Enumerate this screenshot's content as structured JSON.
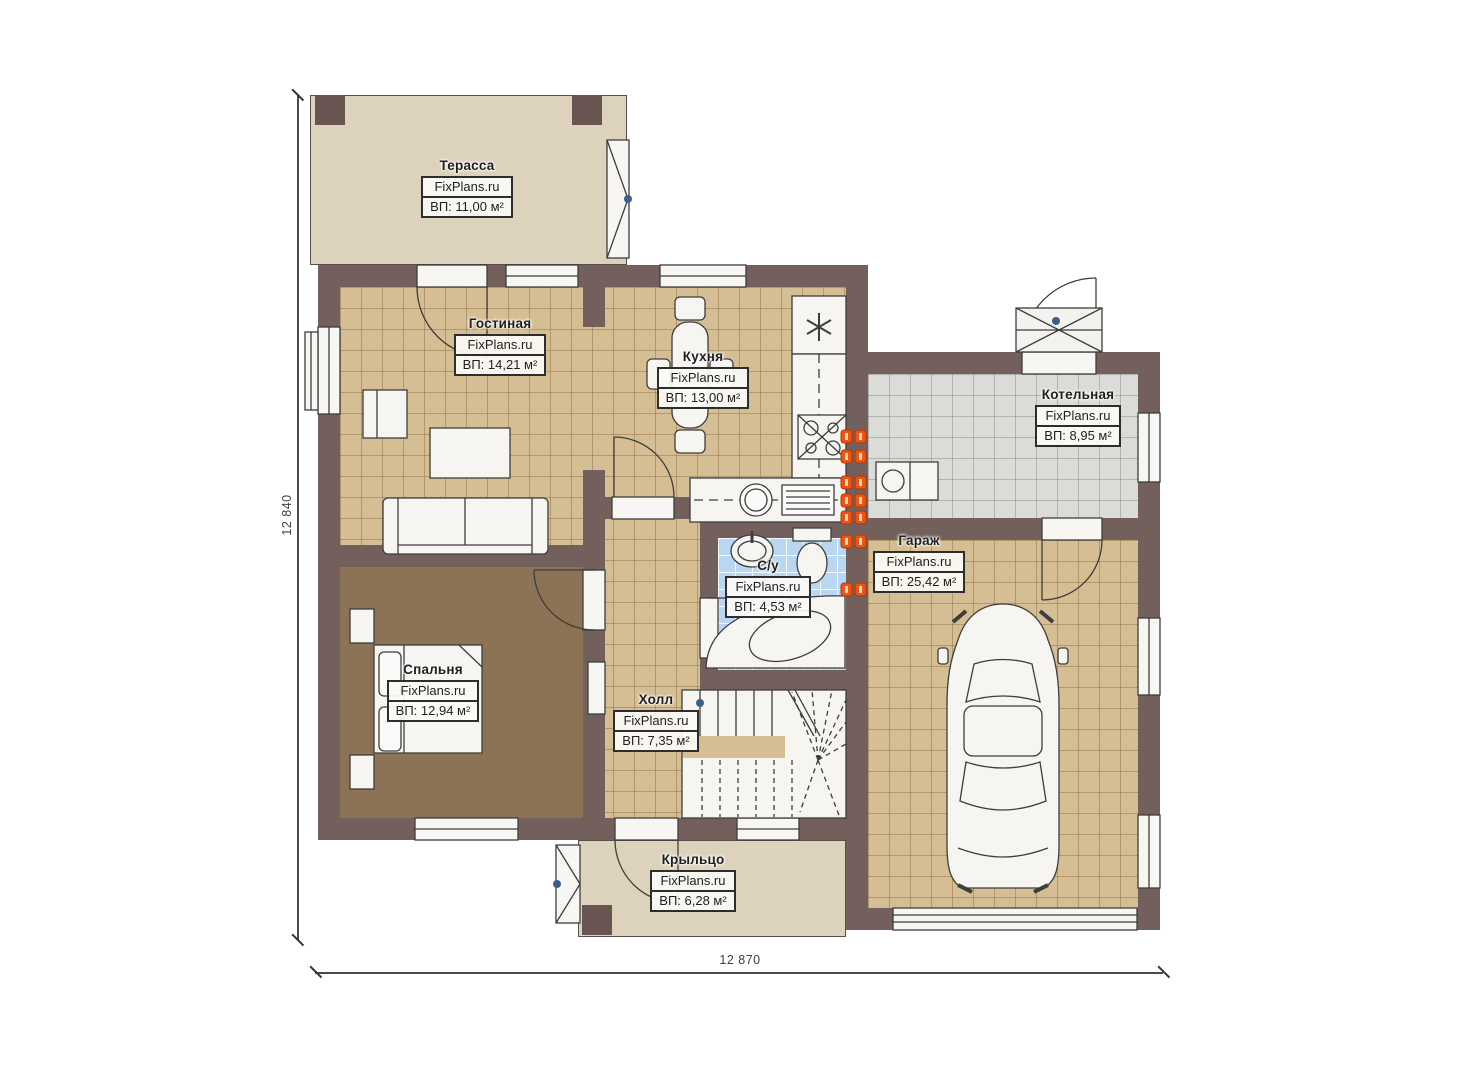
{
  "brand": "FixPlans.ru",
  "dimensions": {
    "left": "12 840",
    "bottom": "12 870"
  },
  "rooms": [
    {
      "key": "terrace",
      "name": "Терасса",
      "watermark": "FixPlans.ru",
      "area": "ВП: 11,00 м²"
    },
    {
      "key": "living",
      "name": "Гостиная",
      "watermark": "FixPlans.ru",
      "area": "ВП: 14,21 м²"
    },
    {
      "key": "kitchen",
      "name": "Кухня",
      "watermark": "FixPlans.ru",
      "area": "ВП: 13,00 м²"
    },
    {
      "key": "boiler",
      "name": "Котельная",
      "watermark": "FixPlans.ru",
      "area": "ВП: 8,95 м²"
    },
    {
      "key": "garage",
      "name": "Гараж",
      "watermark": "FixPlans.ru",
      "area": "ВП: 25,42 м²"
    },
    {
      "key": "bathroom",
      "name": "С/у",
      "watermark": "FixPlans.ru",
      "area": "ВП: 4,53 м²"
    },
    {
      "key": "bedroom",
      "name": "Спальня",
      "watermark": "FixPlans.ru",
      "area": "ВП: 12,94 м²"
    },
    {
      "key": "hall",
      "name": "Холл",
      "watermark": "FixPlans.ru",
      "area": "ВП: 7,35 м²"
    },
    {
      "key": "porch",
      "name": "Крыльцо",
      "watermark": "FixPlans.ru",
      "area": "ВП: 6,28 м²"
    }
  ],
  "icons": {
    "fridge_freezer_symbol": "✳"
  },
  "colors": {
    "wall": "#73605c",
    "floor_tile": "#d5be93",
    "bedroom_floor": "#8c7355",
    "bath_tile": "#b9d7f2",
    "boiler_tile": "#dbdbd8",
    "terrace_floor": "#ddd2bc",
    "radiator_orange": "#f2530e",
    "marker_blue": "#3c5f88"
  }
}
